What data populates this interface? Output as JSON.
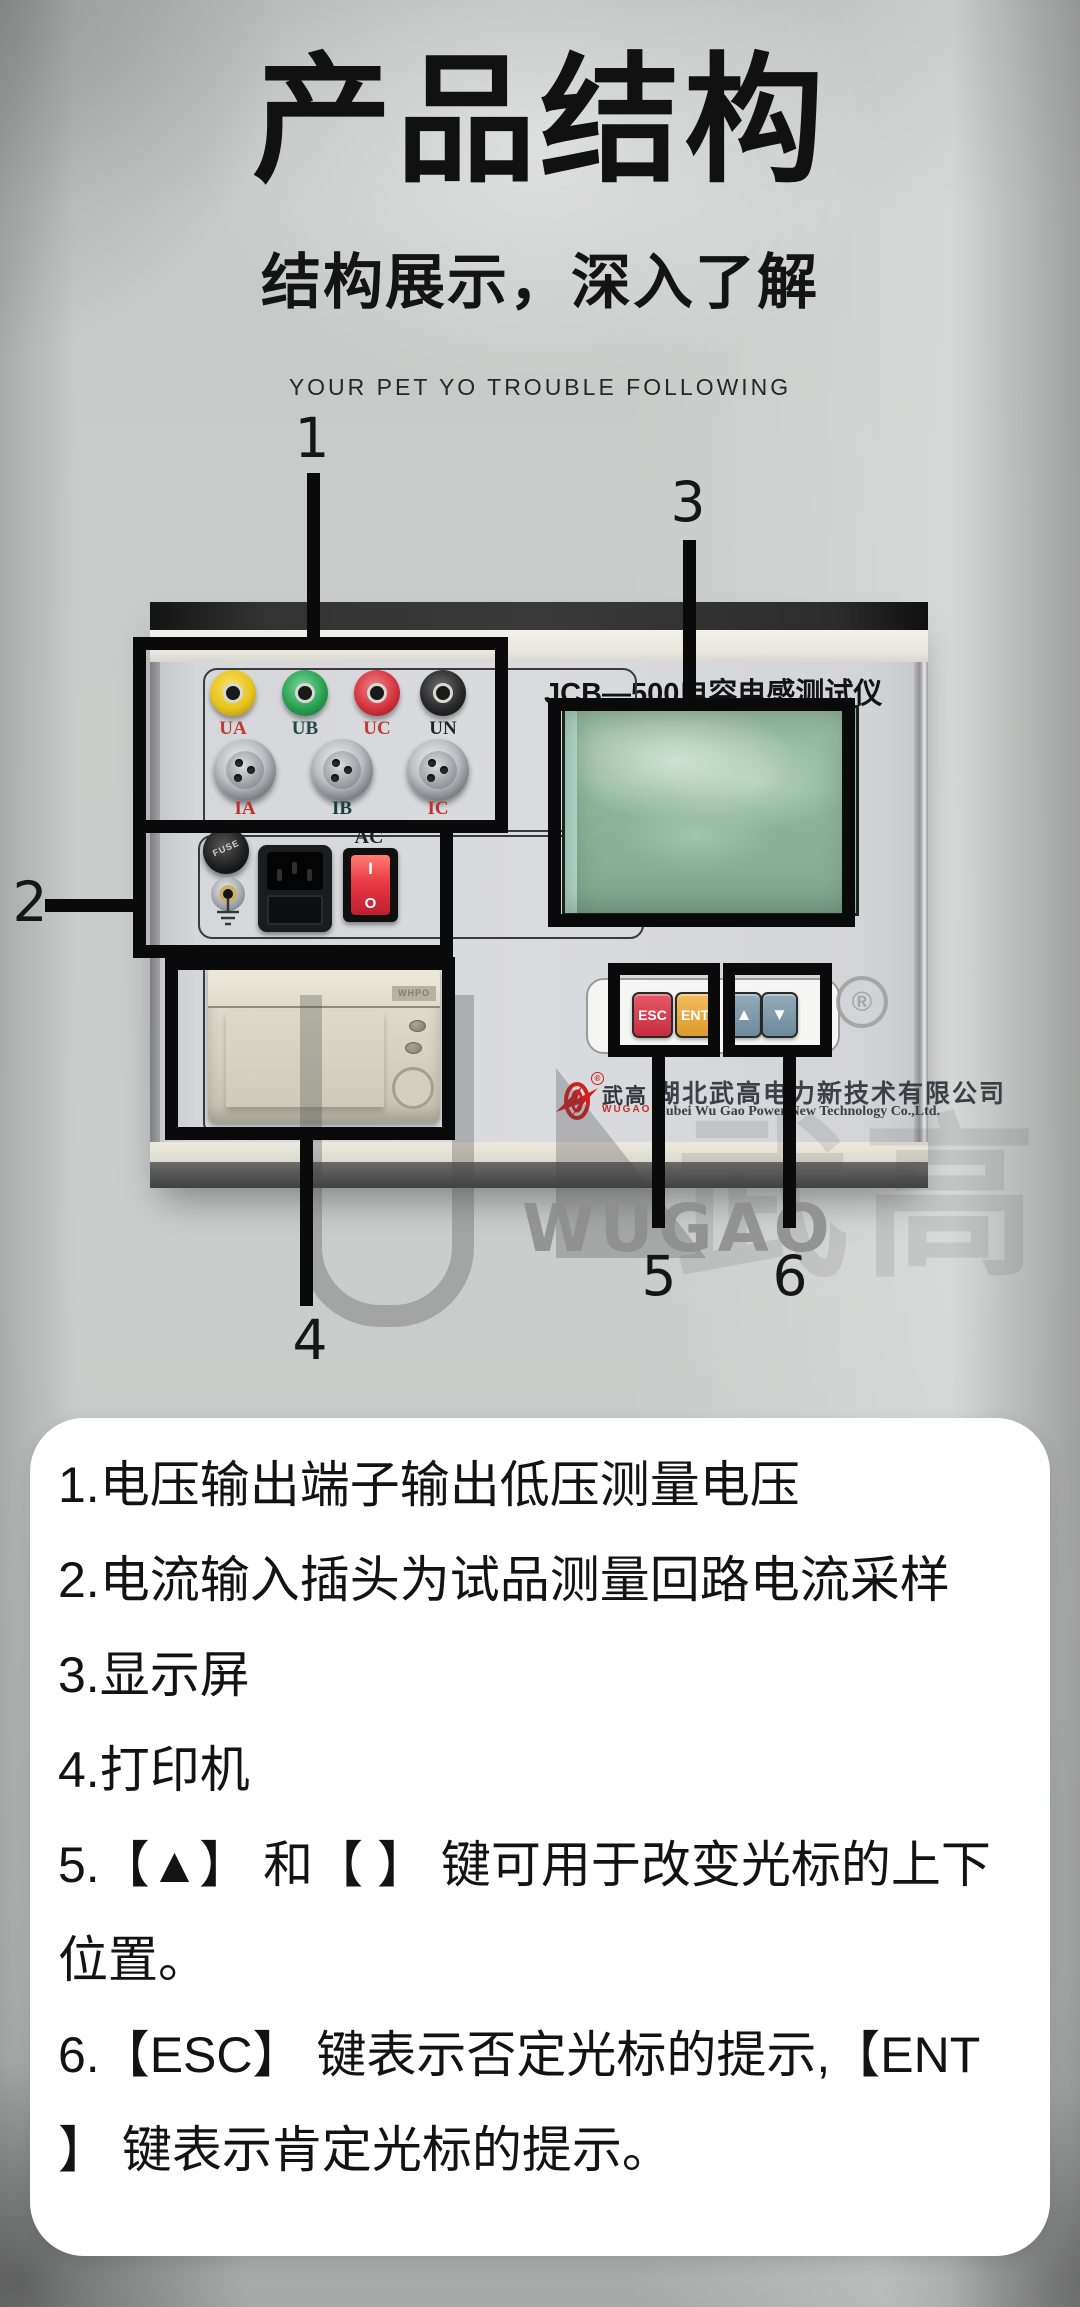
{
  "header": {
    "title": "产品结构",
    "subtitle": "结构展示，深入了解",
    "tagline": "YOUR PET YO TROUBLE FOLLOWING"
  },
  "callouts": [
    "1",
    "2",
    "3",
    "4",
    "5",
    "6"
  ],
  "device": {
    "model_title": "JCB—500电容电感测试仪",
    "voltage_terminals": [
      {
        "label": "UA",
        "color": "#e6c51e"
      },
      {
        "label": "UB",
        "color": "#2ba353"
      },
      {
        "label": "UC",
        "color": "#d63540"
      },
      {
        "label": "UN",
        "color": "#2b2b2b"
      }
    ],
    "current_connectors": [
      {
        "label": "IA"
      },
      {
        "label": "IB"
      },
      {
        "label": "IC"
      }
    ],
    "fuse_label": "FUSE",
    "ac_label": "AC",
    "switch_marks": {
      "on": "I",
      "off": "O"
    },
    "buttons": [
      {
        "label": "ESC",
        "color": "#d23b4e"
      },
      {
        "label": "ENT",
        "color": "#e9a93d"
      },
      {
        "label": "▲",
        "color": "#7d99a8"
      },
      {
        "label": "▼",
        "color": "#7d99a8"
      }
    ],
    "printer_brand": "WHPO",
    "brand": {
      "logo_cn": "武高",
      "logo_en": "WUGAO",
      "registered_mark": "®",
      "company_cn": "湖北武高电力新技术有限公司",
      "company_en": "Hubei Wu Gao Power New Technology Co.,Ltd."
    },
    "watermark_text": "WUGAO"
  },
  "notes": {
    "items": [
      "1.电压输出端子输出低压测量电压",
      "2.电流输入插头为试品测量回路电流采样",
      "3.显示屏",
      "4.打印机",
      "5.【▲】 和【 】 键可用于改变光标的上下位置。",
      "6.【ESC】 键表示否定光标的提示,【ENT】 键表示肯定光标的提示。"
    ],
    "lines": [
      "1.电压输出端子输出低压测量电压",
      "2.电流输入插头为试品测量回路电流采样",
      "3.显示屏",
      "4.打印机",
      "5.【▲】 和【 】 键可用于改变光标的上下",
      "位置。",
      "6.【ESC】 键表示否定光标的提示,【ENT",
      "】 键表示肯定光标的提示。"
    ]
  }
}
